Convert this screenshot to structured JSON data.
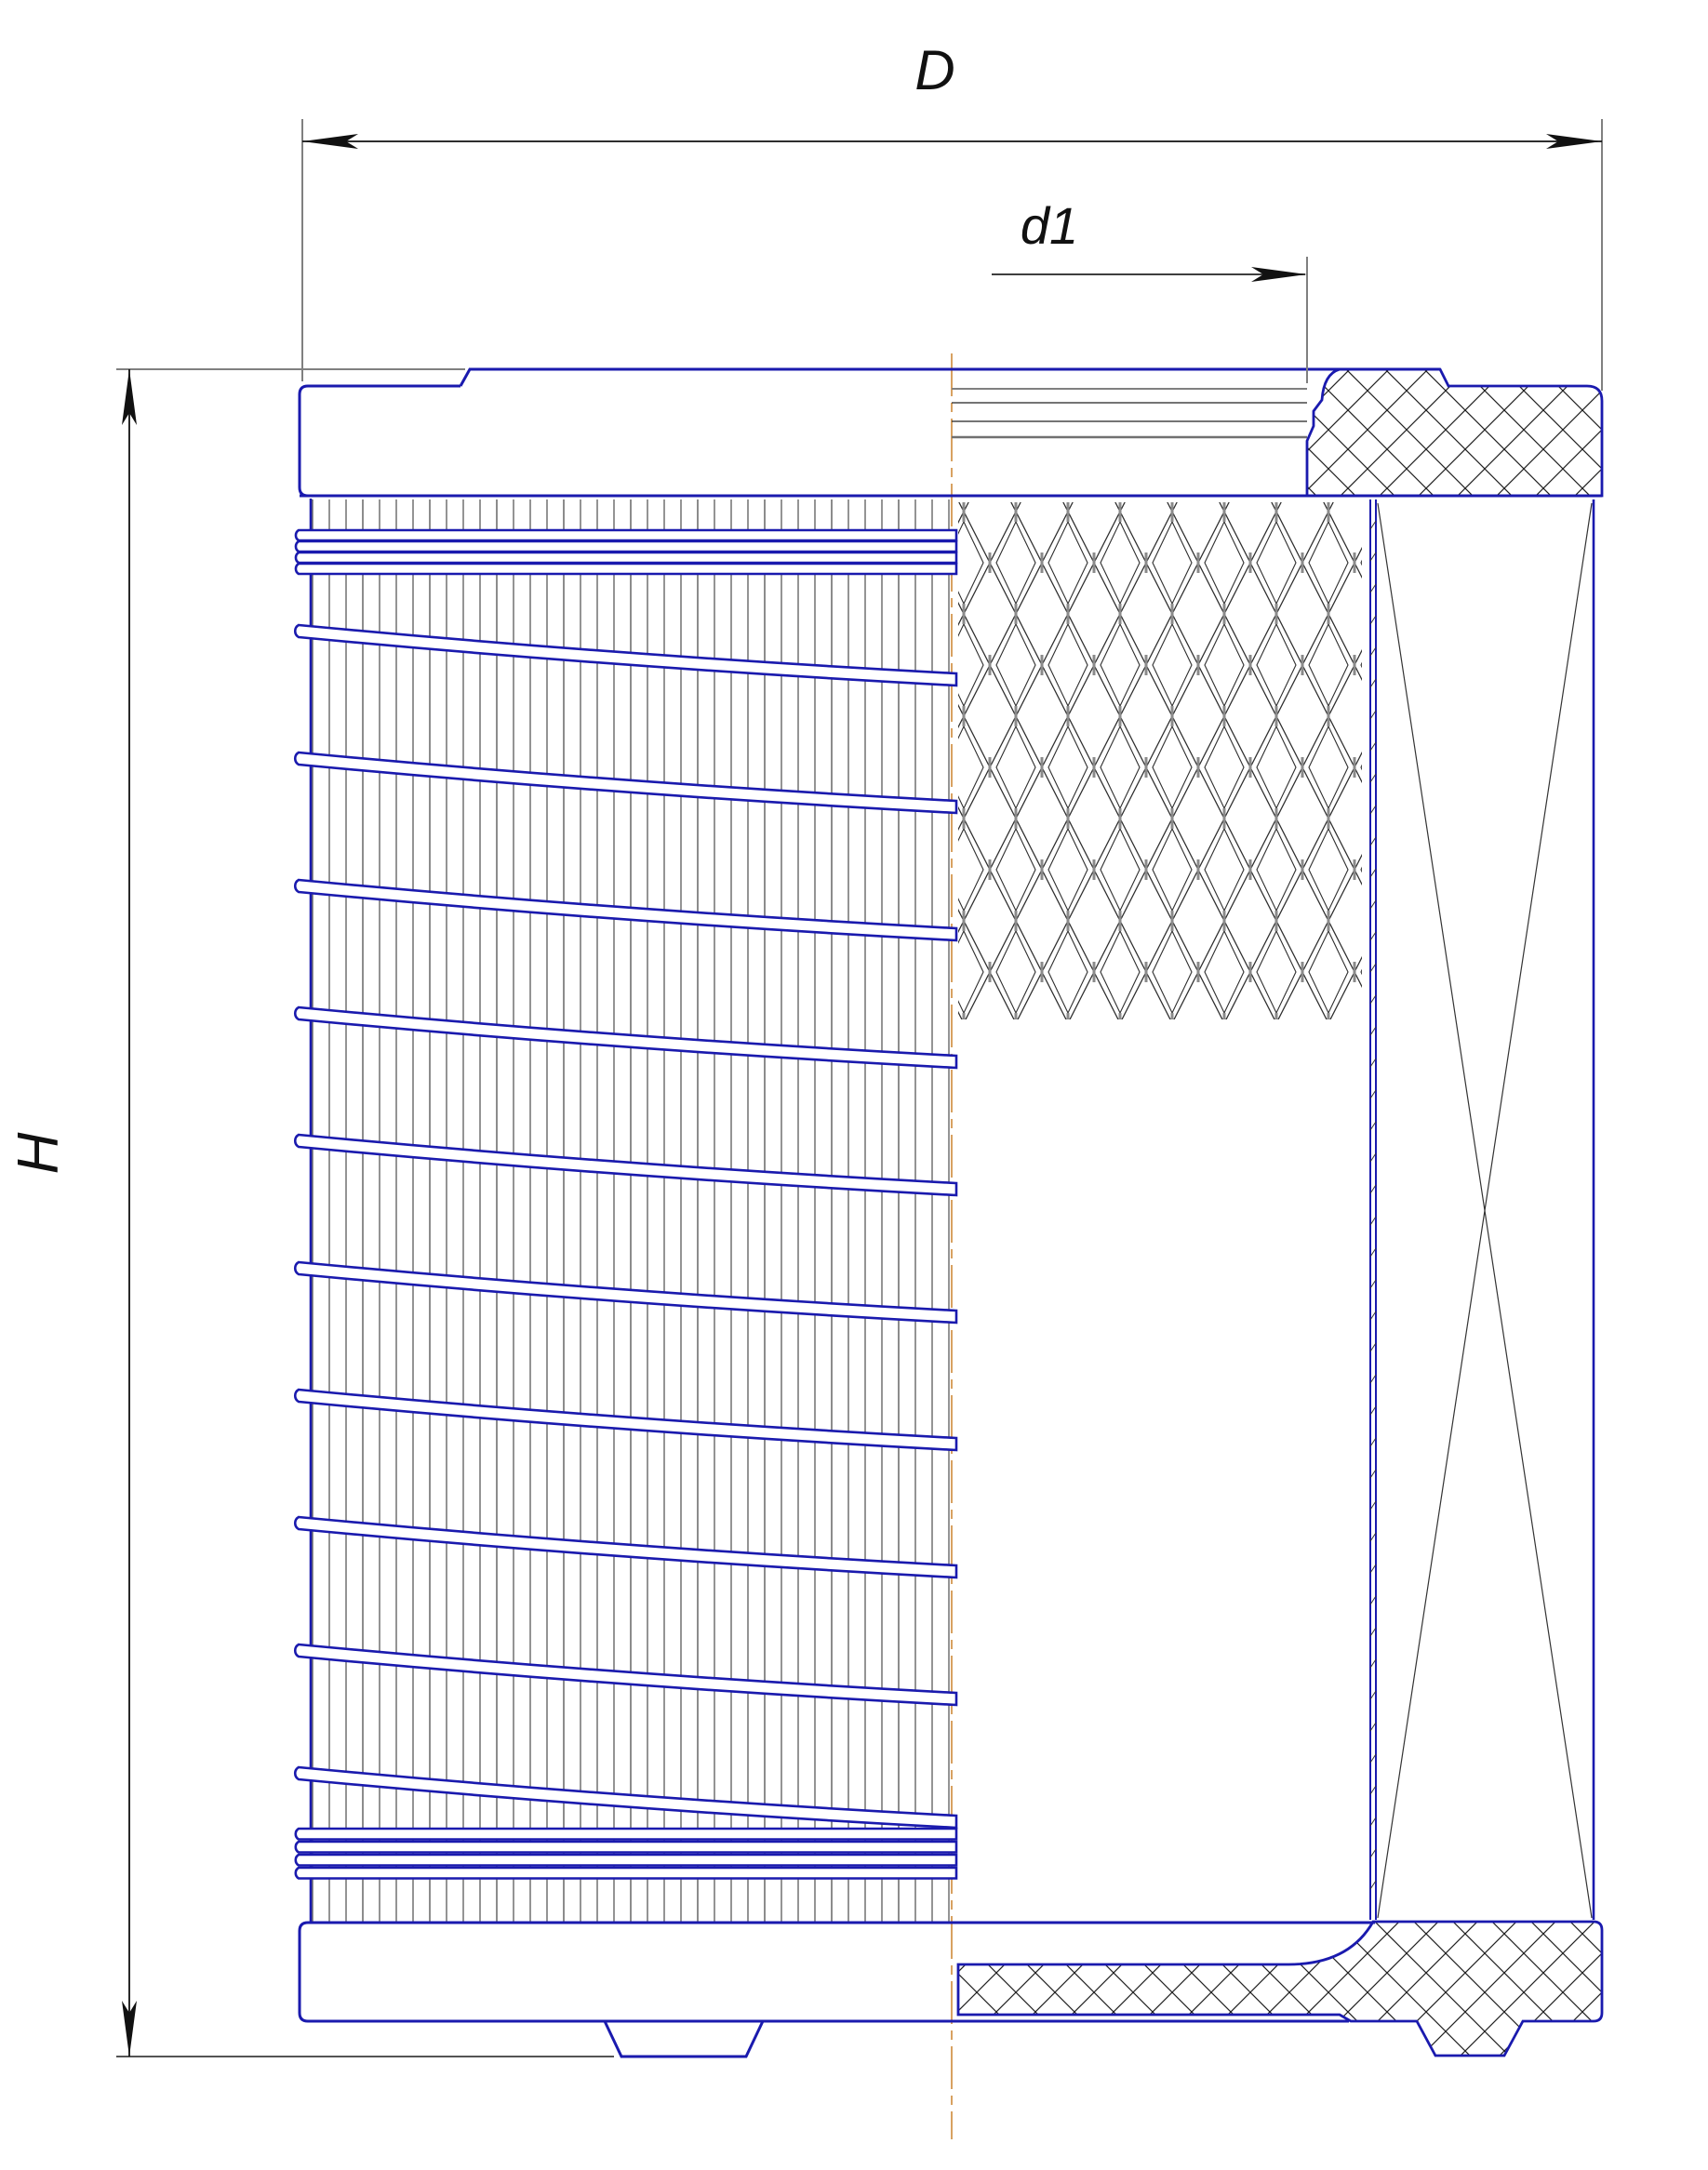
{
  "drawing": {
    "title": "filter-element-technical-drawing",
    "view": "half-section side view of cylindrical filter element",
    "labels": {
      "outer_diameter": "D",
      "inner_diameter": "d1",
      "height": "H"
    },
    "colors": {
      "outline_blue": "#1a1aae",
      "centerline_orange": "#cf8a3a",
      "dimension_black": "#111111",
      "extension_grey": "#808080",
      "hatch_black": "#222222",
      "pleat_dark": "#3c3c3c",
      "pleat_grey": "#8c8c8c"
    }
  }
}
